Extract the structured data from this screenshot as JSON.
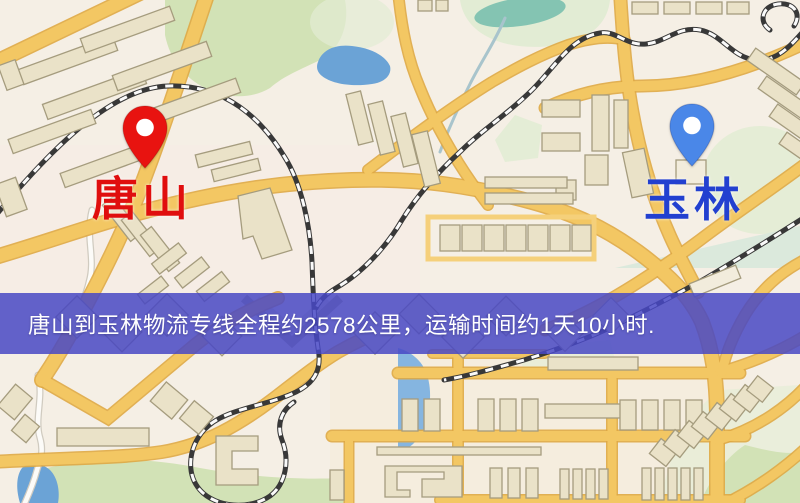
{
  "banner": {
    "text": "唐山到玉林物流专线全程约2578公里，运输时间约1天10小时.",
    "bg_color": "#4848c4",
    "bg_opacity": 0.85,
    "text_color": "#ffffff",
    "top": 293,
    "height": 61
  },
  "markers": [
    {
      "id": "origin",
      "label": "唐山",
      "icon": "location-pin-icon",
      "pin_color": "#e81310",
      "label_color": "#e00e0e",
      "tip_x": 145,
      "tip_y": 168
    },
    {
      "id": "destination",
      "label": "玉林",
      "icon": "location-pin-icon",
      "pin_color": "#4a87e8",
      "label_color": "#2240d0",
      "tip_x": 692,
      "tip_y": 166
    }
  ],
  "map": {
    "colors": {
      "background": "#f5efe5",
      "tint_warm": "#f6e9c8",
      "tint_pink": "#f7ece7",
      "road_fill": "#f3c763",
      "road_casing": "#dfa844",
      "road_light": "#f5d07a",
      "building_fill": "#eae2c8",
      "building_light": "#f2ecdc",
      "building_stroke": "#a59c7e",
      "park": "#d2e2b6",
      "park_pale": "#e2ecd4",
      "park_teal": "#d6e7da",
      "pond_teal": "#84c4b2",
      "water": "#6ba3d6",
      "water_pale": "#85b5e0",
      "stream": "#a8c4cc",
      "railway_dark": "#383838",
      "railway_light": "#fafafa",
      "white_road": "#fcfbf8",
      "white_road_casing": "#d0cbc0",
      "chevron_dark": "#b6ae92",
      "chevron_light": "#ddd6c0"
    }
  }
}
